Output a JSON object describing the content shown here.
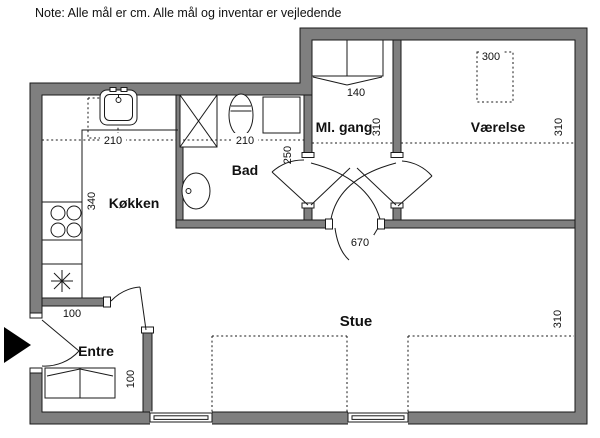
{
  "note": "Note: Alle mål er cm. Alle mål og inventar er vejledende",
  "rooms": {
    "kitchen": {
      "label": "Køkken",
      "width_cm": "210",
      "length_cm": "340"
    },
    "bath": {
      "label": "Bad",
      "width_cm": "210",
      "depth_cm": "250"
    },
    "hall": {
      "label": "Ml. gang",
      "wardrobe_width_cm": "140",
      "depth_cm": "310"
    },
    "bedroom": {
      "label": "Værelse",
      "closet_dim_cm": "300",
      "depth_cm": "310"
    },
    "living": {
      "label": "Stue",
      "width_cm": "670",
      "depth_cm": "310"
    },
    "entry": {
      "label": "Entre",
      "width_cm": "100",
      "depth_cm": "100"
    }
  },
  "colors": {
    "wall": "#7f7f7f",
    "line": "#1a1a1a",
    "background": "#ffffff",
    "entrance_arrow": "#000000"
  }
}
